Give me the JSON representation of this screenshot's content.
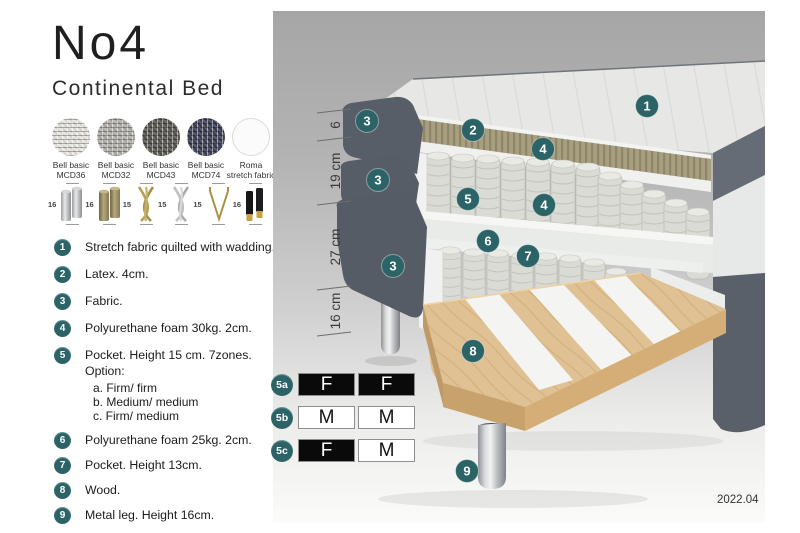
{
  "header": {
    "title": "No4",
    "subtitle": "Continental Bed"
  },
  "fabrics": [
    {
      "line1": "Bell basic",
      "line2": "MCD36",
      "color": "#e8e5df"
    },
    {
      "line1": "Bell basic",
      "line2": "MCD32",
      "color": "#b3b0ab"
    },
    {
      "line1": "Bell basic",
      "line2": "MCD43",
      "color": "#595751"
    },
    {
      "line1": "Bell basic",
      "line2": "MCD74",
      "color": "#3c3f55"
    },
    {
      "line1": "Roma",
      "line2": "stretch fabric",
      "color": "#fbfbfb"
    }
  ],
  "legs": [
    {
      "height": "16",
      "style": "chrome cylinder pair"
    },
    {
      "height": "16",
      "style": "wood cylinder pair"
    },
    {
      "height": "15",
      "style": "gold twisted cross"
    },
    {
      "height": "15",
      "style": "silver twisted cross"
    },
    {
      "height": "15",
      "style": "gold hairpin"
    },
    {
      "height": "16",
      "style": "black cylinder with gold tip pair"
    }
  ],
  "spec_items": [
    {
      "num": "1",
      "text": "Stretch fabric quilted with wadding."
    },
    {
      "num": "2",
      "text": "Latex. 4cm."
    },
    {
      "num": "3",
      "text": "Fabric."
    },
    {
      "num": "4",
      "text": "Polyurethane foam 30kg. 2cm."
    },
    {
      "num": "5",
      "text": "Pocket. Height 15 cm. 7zones. Option:",
      "options": [
        "a. Firm/ firm",
        "b. Medium/ medium",
        "c. Firm/ medium"
      ]
    },
    {
      "num": "6",
      "text": "Polyurethane foam 25kg. 2cm."
    },
    {
      "num": "7",
      "text": "Pocket. Height 13cm."
    },
    {
      "num": "8",
      "text": "Wood."
    },
    {
      "num": "9",
      "text": "Metal leg. Height 16cm."
    }
  ],
  "illustration": {
    "badges": [
      "1",
      "3",
      "2",
      "4",
      "3",
      "5",
      "4",
      "6",
      "7",
      "3",
      "8",
      "9"
    ],
    "measurements": [
      "6",
      "19 cm",
      "27 cm",
      "16 cm"
    ]
  },
  "firmness": [
    {
      "id": "5a",
      "cells": [
        {
          "label": "F",
          "bg": "#0a0a0a",
          "fg": "#ffffff"
        },
        {
          "label": "F",
          "bg": "#0a0a0a",
          "fg": "#ffffff"
        }
      ]
    },
    {
      "id": "5b",
      "cells": [
        {
          "label": "M",
          "bg": "#ffffff",
          "fg": "#111111"
        },
        {
          "label": "M",
          "bg": "#ffffff",
          "fg": "#111111"
        }
      ]
    },
    {
      "id": "5c",
      "cells": [
        {
          "label": "F",
          "bg": "#0a0a0a",
          "fg": "#ffffff"
        },
        {
          "label": "M",
          "bg": "#ffffff",
          "fg": "#111111"
        }
      ]
    }
  ],
  "footer": {
    "version": "2022.04"
  },
  "colors": {
    "badge": "#2b6367",
    "latex": "#a79f80",
    "wood": "#dfc193",
    "fabric_dark": "#575d67",
    "panel_top": "#a6a6a6",
    "panel_bottom": "#fbfbfa"
  }
}
